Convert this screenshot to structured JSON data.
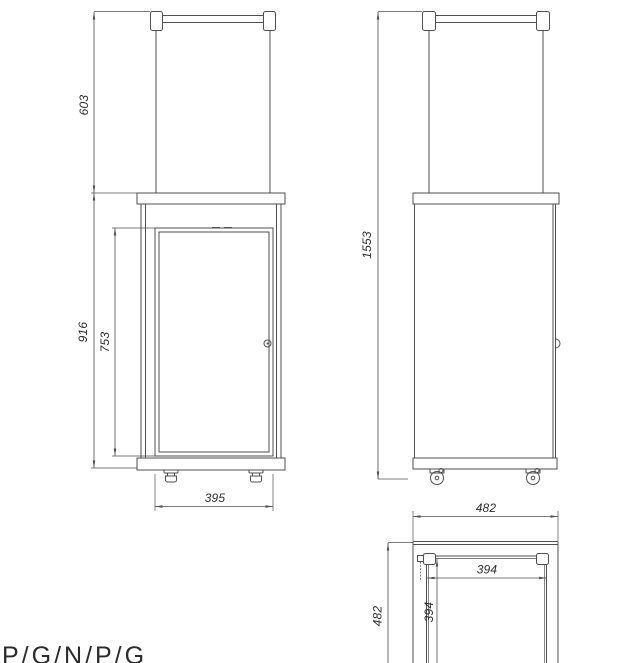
{
  "drawing": {
    "title": "patio-heater-technical-drawing",
    "front_view": {
      "dims": {
        "handle_section_height": "603",
        "body_height": "916",
        "door_height": "753",
        "door_width": "395"
      }
    },
    "side_view": {
      "dims": {
        "total_height": "1553"
      }
    },
    "top_view": {
      "dims": {
        "outer_width": "482",
        "outer_depth": "482",
        "inner_width": "394",
        "inner_depth": "394"
      }
    },
    "footer": {
      "model_code": "P/G/N/P/G"
    },
    "colors": {
      "line": "#4f4f4f",
      "text": "#2b2b2b",
      "background": "#ffffff"
    }
  }
}
